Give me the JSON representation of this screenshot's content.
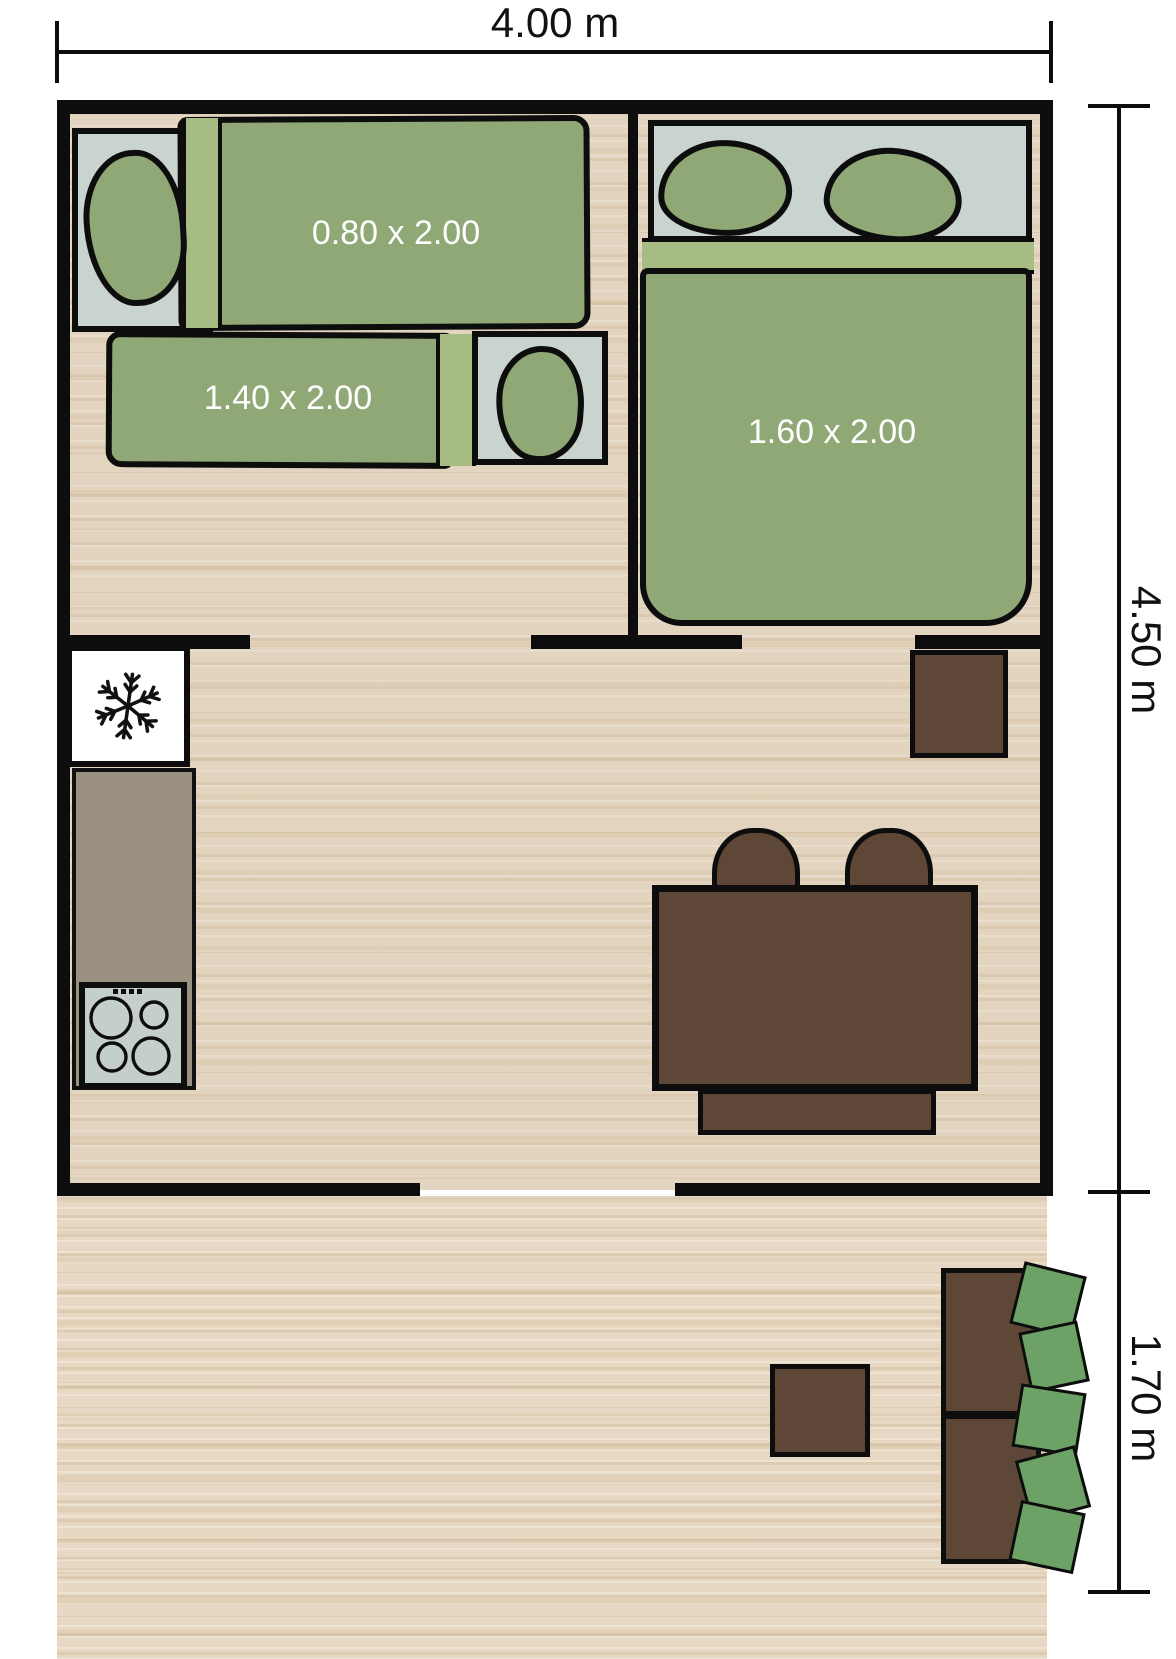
{
  "plan": {
    "type": "floor-plan",
    "dimensions": {
      "top": "4.00 m",
      "right_upper": "4.50 m",
      "right_lower": "1.70 m"
    },
    "bedroom_left": {
      "single_bed_label": "0.80 x 2.00",
      "double_bed_label": "1.40 x 2.00"
    },
    "bedroom_right": {
      "double_bed_label": "1.60 x 2.00"
    },
    "icons": {
      "fridge": "snowflake-icon",
      "stove": "four-burner-stove-icon"
    },
    "colors": {
      "wall": "#0d0d0d",
      "floor": "#e2d4bf",
      "terrace_floor": "#e6d8c2",
      "bed_green": "#8fa876",
      "bed_band_green": "#a6bc82",
      "headboard_gray": "#c9d4cf",
      "furniture_brown": "#5e4736",
      "bush_green": "#6ca266",
      "counter_taupe": "#9a9180",
      "stove_gray": "#c4cfca",
      "bed_label_color": "#ffffff",
      "dimension_label_color": "#111111"
    }
  }
}
